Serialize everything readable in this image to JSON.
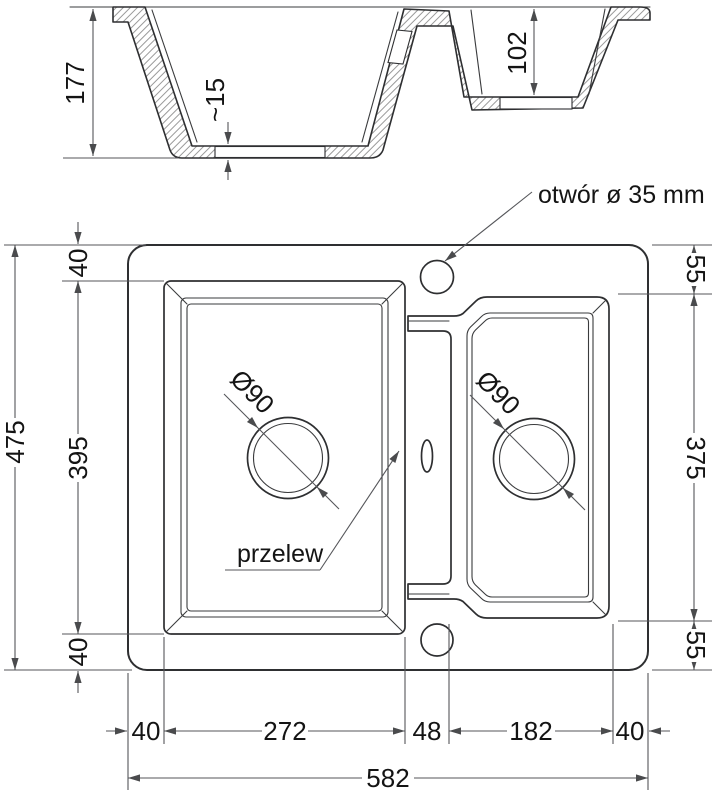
{
  "drawing": {
    "section": {
      "total_depth": "177",
      "small_basin_depth": "102",
      "floor_thickness": "~15"
    },
    "plan": {
      "faucet_hole_label": "otwór ø 35 mm",
      "overflow_label": "przelew",
      "drain_diameter_left": "Ø90",
      "drain_diameter_right": "Ø90",
      "left_top_offset": "40",
      "left_basin_length": "395",
      "left_bottom_offset": "40",
      "total_length": "475",
      "right_top_offset": "55",
      "right_basin_length": "375",
      "right_bottom_offset": "55",
      "bottom_left_margin": "40",
      "left_basin_width": "272",
      "divider_width": "48",
      "right_basin_width": "182",
      "bottom_right_margin": "40",
      "total_width": "582"
    },
    "colors": {
      "outline": "#2e2f31",
      "dimension": "#55565a",
      "background": "#ffffff"
    }
  }
}
